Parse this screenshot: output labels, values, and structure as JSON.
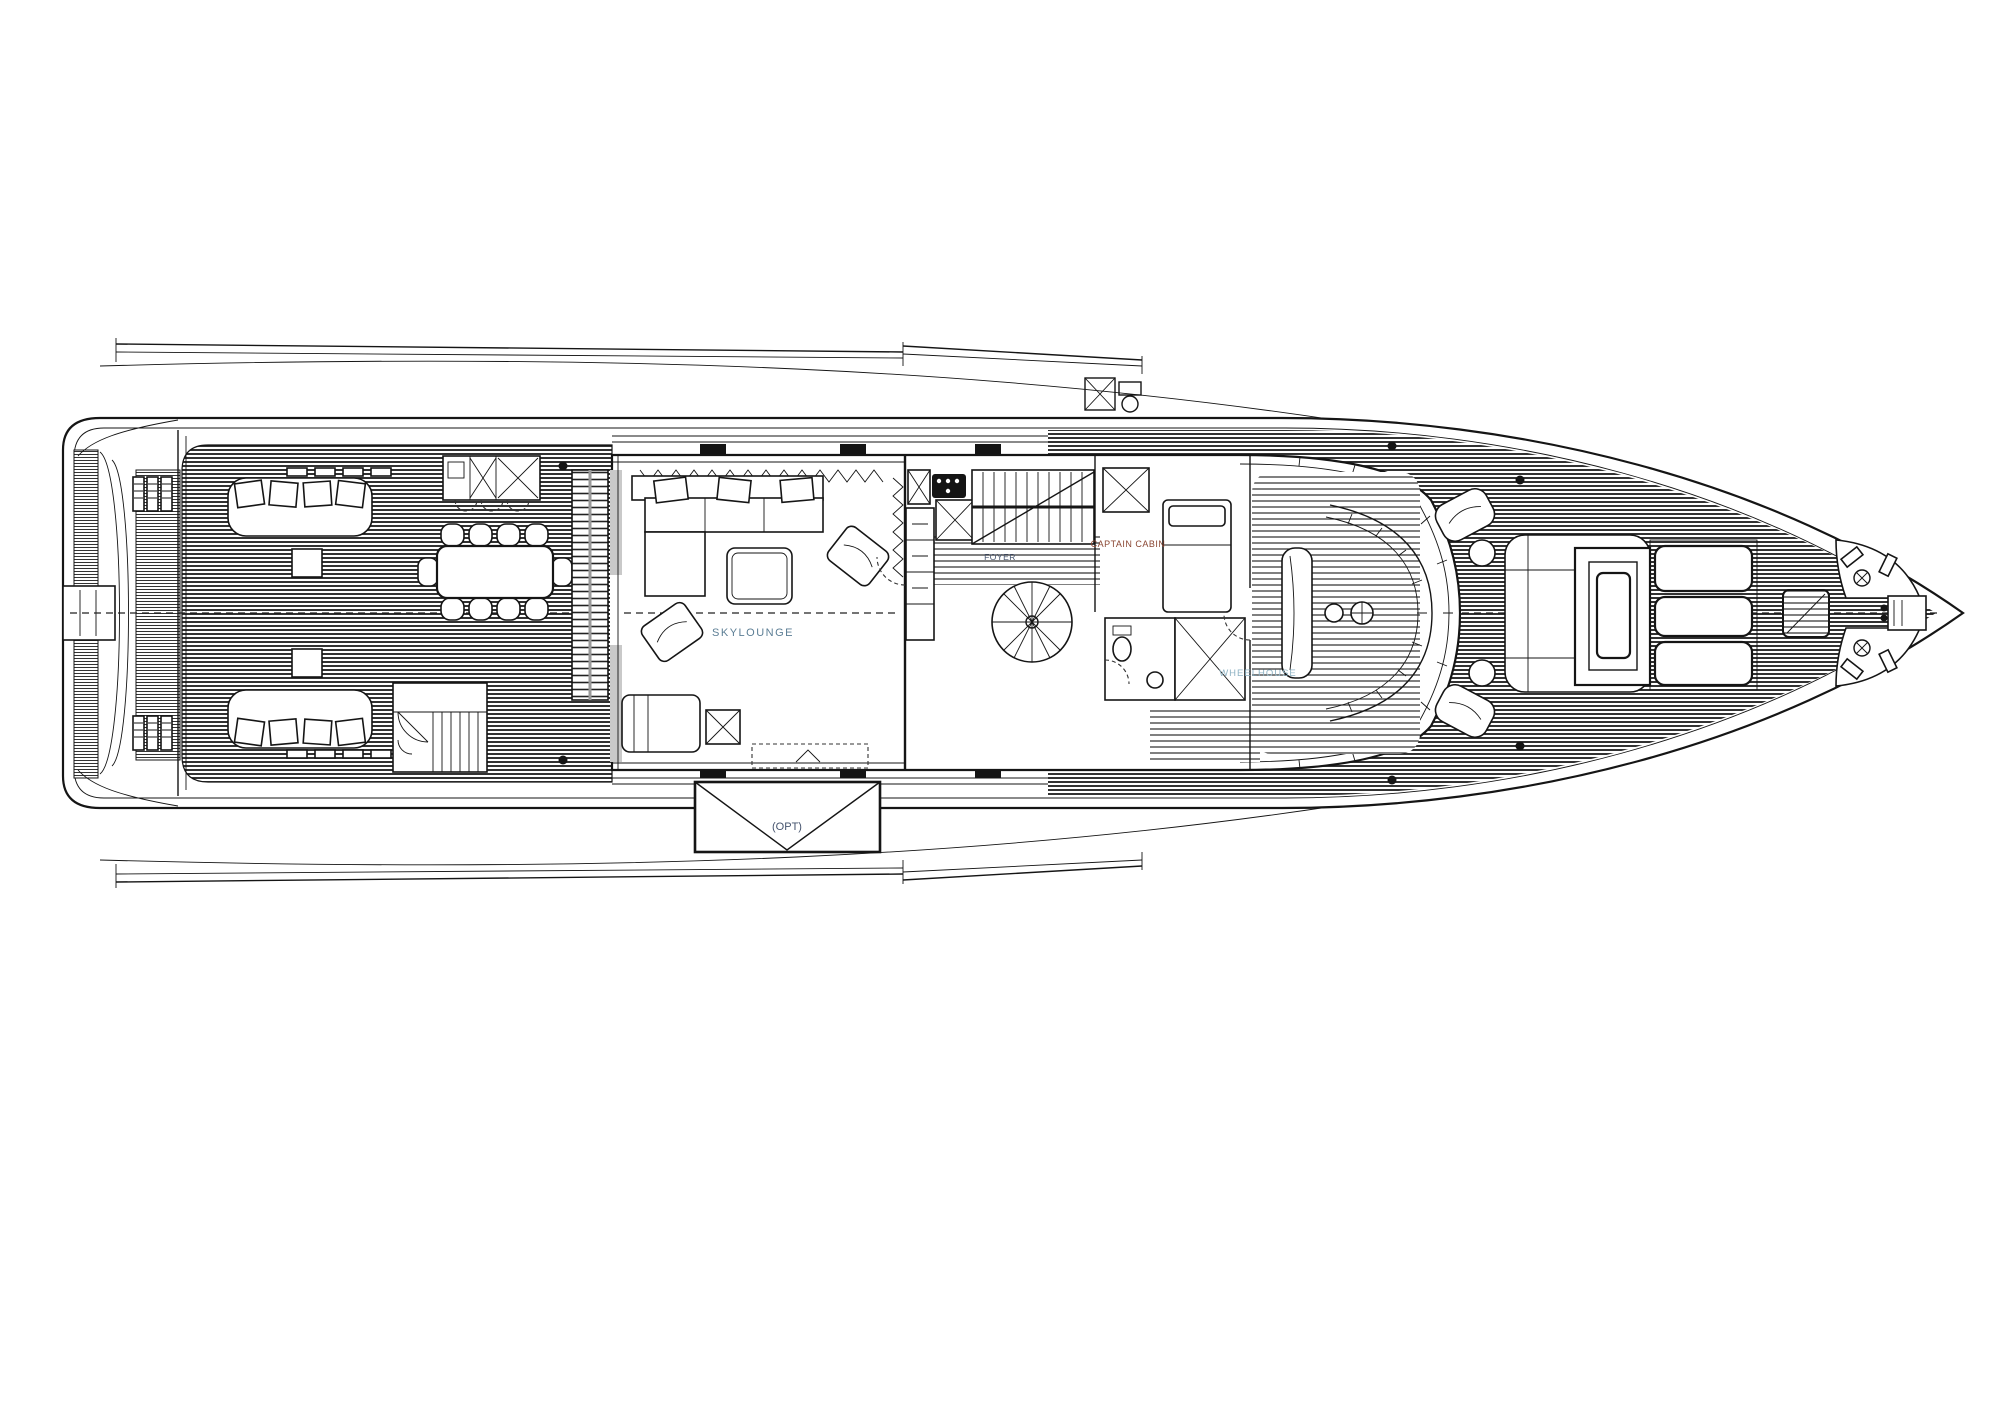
{
  "diagram": {
    "type": "yacht-deck-plan",
    "view": "top-down",
    "orientation": "bow-right",
    "labels": {
      "skylounge": "SKYLOUNGE",
      "captain_cabin": "CAPTAIN CABIN",
      "foyer": "FOYER",
      "wheelhouse": "WHEELHOUSE",
      "optional_platform": "(OPT)"
    },
    "colors": {
      "paper": "#ffffff",
      "ink": "#151515",
      "label_blue_gray": "#5c7e95",
      "label_red_brown": "#8a4632",
      "label_navy": "#46546e",
      "label_light_blue": "#8fb3c4"
    }
  }
}
